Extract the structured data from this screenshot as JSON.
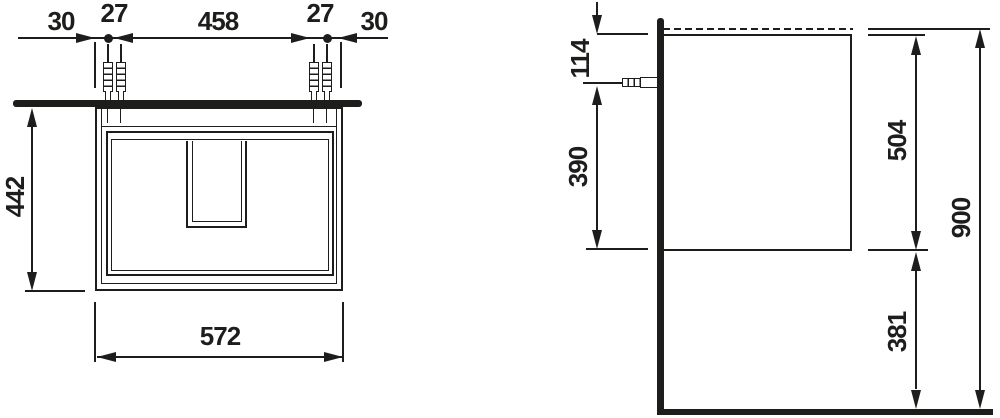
{
  "drawing_type": "technical dimension drawing (vanity cabinet, front and side view)",
  "colors": {
    "ink": "#1d1d1b",
    "background": "#ffffff"
  },
  "front_view": {
    "dims_top": [
      "30",
      "27",
      "458",
      "27",
      "30"
    ],
    "height": "442",
    "width": "572"
  },
  "side_view": {
    "top_to_anchor": "114",
    "anchor_to_bottom": "390",
    "body_height": "504",
    "overall_height": "900",
    "bottom_clearance": "381"
  }
}
